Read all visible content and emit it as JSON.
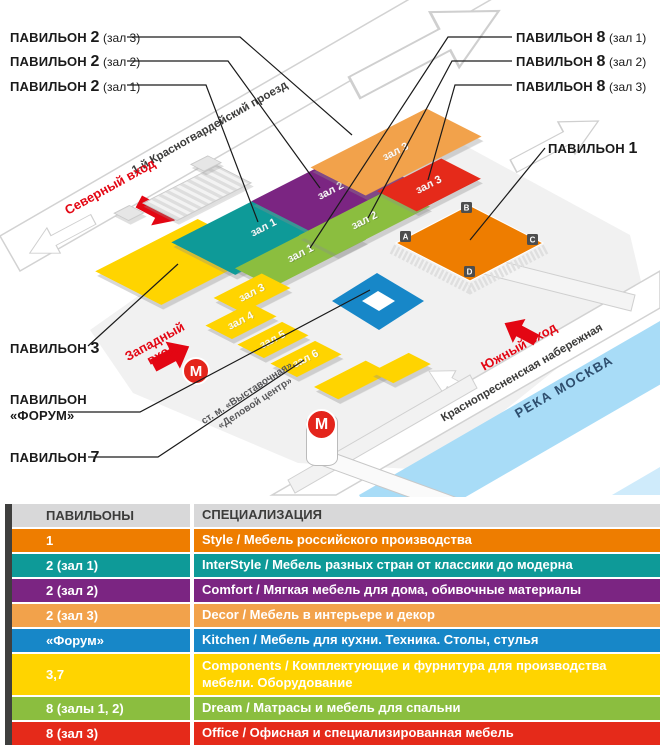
{
  "map": {
    "callouts_left": [
      {
        "prefix": "ПАВИЛЬОН",
        "num": "2",
        "hall": "(зал 3)"
      },
      {
        "prefix": "ПАВИЛЬОН",
        "num": "2",
        "hall": "(зал 2)"
      },
      {
        "prefix": "ПАВИЛЬОН",
        "num": "2",
        "hall": "(зал 1)"
      }
    ],
    "callouts_right": [
      {
        "prefix": "ПАВИЛЬОН",
        "num": "8",
        "hall": "(зал 1)"
      },
      {
        "prefix": "ПАВИЛЬОН",
        "num": "8",
        "hall": "(зал 2)"
      },
      {
        "prefix": "ПАВИЛЬОН",
        "num": "8",
        "hall": "(зал 3)"
      }
    ],
    "callout_p1": {
      "prefix": "ПАВИЛЬОН",
      "num": "1"
    },
    "callout_p3": {
      "prefix": "ПАВИЛЬОН",
      "num": "3"
    },
    "callout_forum": {
      "line1": "ПАВИЛЬОН",
      "line2": "«ФОРУМ»"
    },
    "callout_p7": {
      "prefix": "ПАВИЛЬОН",
      "num": "7"
    },
    "streets": {
      "north_road": "1-й Красногвардейский проезд",
      "embankment": "Краснопресненская набережная",
      "river": "РЕКА МОСКВА"
    },
    "entrances": {
      "north": "Северный вход",
      "west": "Западный вход",
      "south": "Южный вход"
    },
    "metro": {
      "letter": "М",
      "station_line1": "ст. м. «Выставочная»,",
      "station_line2": "«Деловой центр»"
    },
    "halls": {
      "p2z1": "зал 1",
      "p2z2": "зал 2",
      "p2z3": "зал 3",
      "p8z1": "зал 1",
      "p8z2": "зал 2",
      "p8z3": "зал 3",
      "p7z3": "зал 3",
      "p7z4": "зал 4",
      "p7z5": "зал 5",
      "p7z6": "зал 6"
    },
    "pav1_markers": [
      "A",
      "B",
      "C",
      "D"
    ],
    "colors": {
      "pav1_orange": "#EE7D00",
      "teal": "#0E9A98",
      "purple": "#7B2582",
      "amber": "#F2A24B",
      "forum_blue": "#1787C8",
      "yellow": "#FFD400",
      "green": "#8BBE3F",
      "red": "#E52A1A",
      "entrance_red": "#E30613",
      "metro_red": "#E4251C",
      "river_blue": "#A8DCF7"
    }
  },
  "legend": {
    "header": {
      "pavilions": "ПАВИЛЬОНЫ",
      "specialization": "СПЕЦИАЛИЗАЦИЯ"
    },
    "rows": [
      {
        "pavilion": "1",
        "spec": "Style / Мебель российского производства",
        "color": "#EE7D00"
      },
      {
        "pavilion": "2 (зал 1)",
        "spec": "InterStyle / Мебель разных стран от классики до модерна",
        "color": "#0E9A98"
      },
      {
        "pavilion": "2 (зал 2)",
        "spec": "Comfort / Мягкая мебель для дома, обивочные материалы",
        "color": "#7B2582"
      },
      {
        "pavilion": "2 (зал 3)",
        "spec": "Decor / Мебель в интерьере и декор",
        "color": "#F2A24B"
      },
      {
        "pavilion": "«Форум»",
        "spec": "Kitchen / Мебель для кухни. Техника. Столы, стулья",
        "color": "#1787C8"
      },
      {
        "pavilion": "3,7",
        "spec": "Components / Комплектующие и фурнитура для производства мебели. Оборудование",
        "color": "#FFD400"
      },
      {
        "pavilion": "8 (залы 1, 2)",
        "spec": "Dream / Матрасы и мебель для спальни",
        "color": "#8BBE3F"
      },
      {
        "pavilion": "8 (зал 3)",
        "spec": "Office / Офисная и специализированная мебель",
        "color": "#E52A1A"
      }
    ]
  }
}
